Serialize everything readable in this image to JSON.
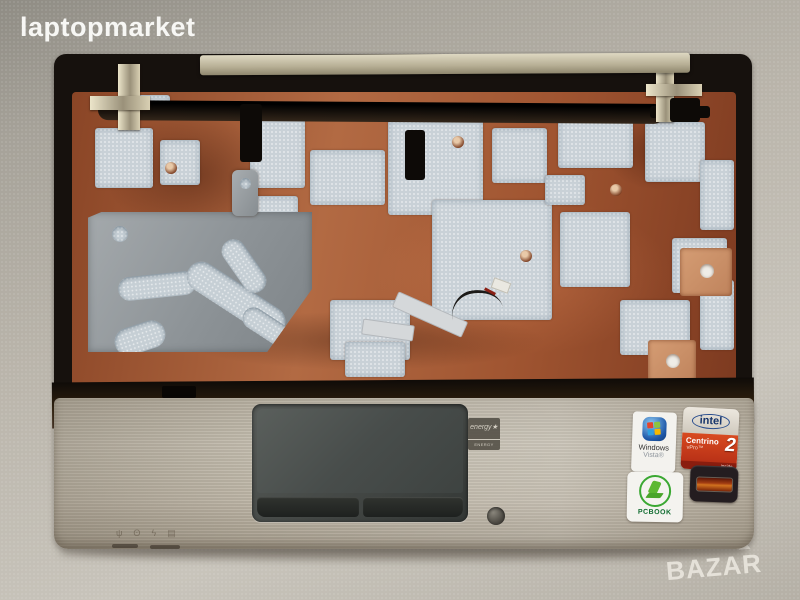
{
  "watermarks": {
    "seller": "laptopmarket",
    "marketplace": "BAZAR"
  },
  "stickers": {
    "energy_star": {
      "script": "energy",
      "star": "★",
      "label": "ENERGY STAR"
    },
    "windows_vista": {
      "line1": "Windows",
      "line2": "Vista®"
    },
    "intel_centrino": {
      "brand": "intel",
      "product": "Centrino",
      "sub": "vPro™",
      "version": "2",
      "inside": "inside"
    },
    "pcbook": {
      "label": "PCBOOK"
    }
  },
  "palmrest": {
    "front_leds": [
      {
        "name": "wireless-led",
        "glyph": "ψ"
      },
      {
        "name": "power-led",
        "glyph": "ʘ"
      },
      {
        "name": "charge-led",
        "glyph": "ϟ"
      },
      {
        "name": "hdd-led",
        "glyph": "▤"
      }
    ]
  },
  "colors": {
    "palmrest_silver": "#bdb5a6",
    "copper_shield": "#9c4f2e",
    "foam_pad": "#c9d1d7",
    "plastic_black": "#16110d",
    "touchpad_gray": "#474c4a",
    "intel_red": "#c43318",
    "pcbook_green": "#3aa832",
    "vista_blue": "#1e58a8",
    "fingerprint_amber": "#a33d12"
  }
}
